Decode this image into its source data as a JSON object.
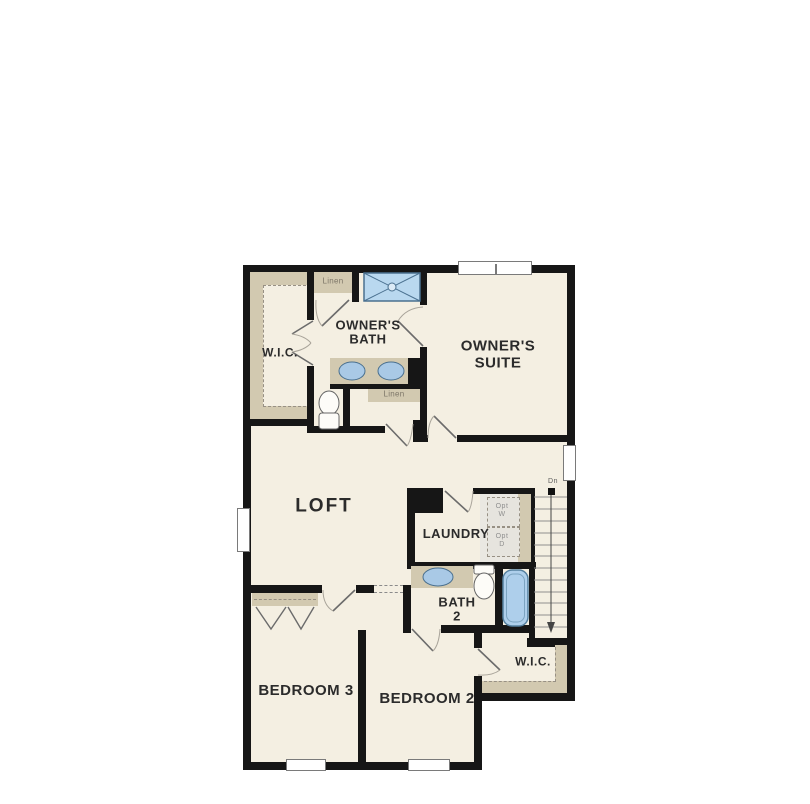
{
  "floorplan": {
    "title": "Second floor plan",
    "rooms": {
      "wic_owner": {
        "label": "W.I.C."
      },
      "owners_bath": {
        "line1": "OWNER'S",
        "line2": "BATH"
      },
      "owners_suite": {
        "line1": "OWNER'S",
        "line2": "SUITE"
      },
      "loft": {
        "label": "LOFT"
      },
      "laundry": {
        "label": "LAUNDRY"
      },
      "bath2": {
        "line1": "BATH",
        "line2": "2"
      },
      "bedroom3": {
        "label": "BEDROOM 3"
      },
      "bedroom2": {
        "label": "BEDROOM 2"
      },
      "wic_bedroom2": {
        "label": "W.I.C."
      }
    },
    "closets": {
      "linen_upper": {
        "label": "Linen"
      },
      "linen_lower": {
        "label": "Linen"
      }
    },
    "stairs": {
      "direction_label": "Dn"
    },
    "appliances": {
      "washer": {
        "line1": "Opt",
        "line2": "W"
      },
      "dryer": {
        "line1": "Opt",
        "line2": "D"
      }
    },
    "colors": {
      "wall": "#161616",
      "floor": "#f4efe2",
      "shelf_tan": "#d2c9b0",
      "shower_blue": "#b9d8ef",
      "tub_blue": "#aecfeb",
      "sink_blue": "#a9c9e6",
      "page_background": "#ffffff"
    }
  }
}
